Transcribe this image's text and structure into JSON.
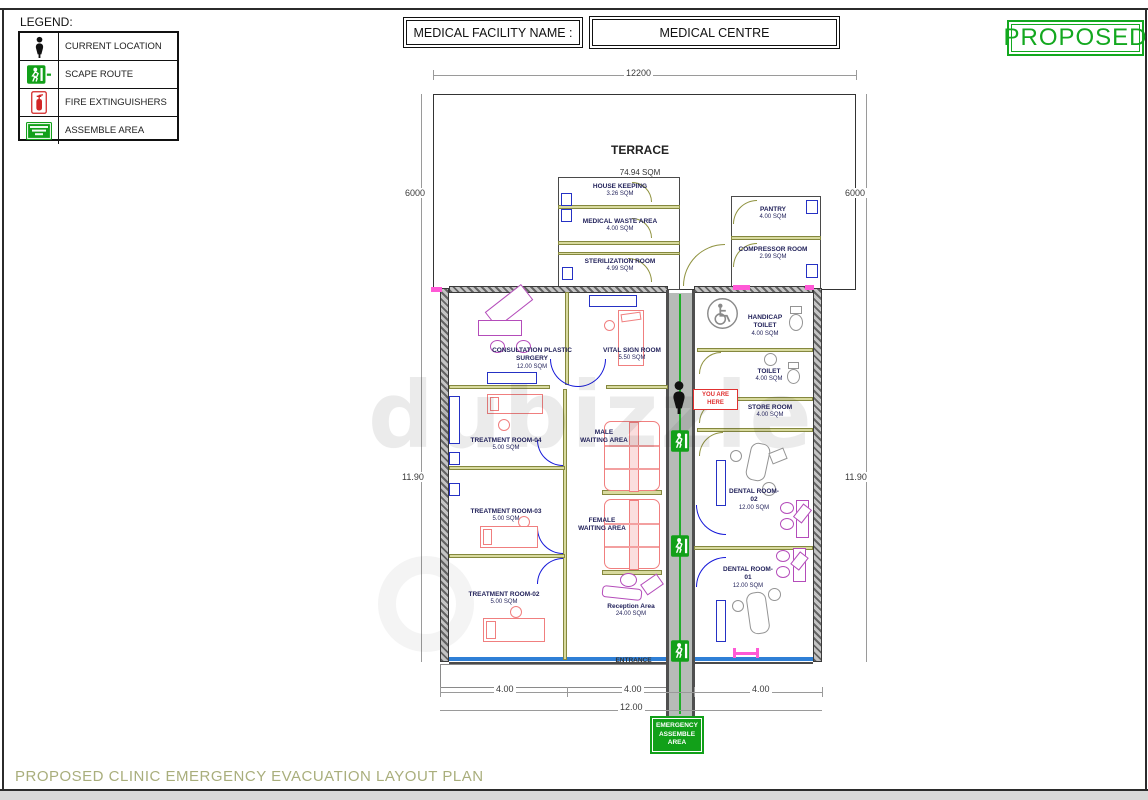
{
  "legend": {
    "title": "LEGEND:",
    "items": [
      {
        "icon": "current-location-icon",
        "label": "CURRENT LOCATION"
      },
      {
        "icon": "escape-route-icon",
        "label": "SCAPE ROUTE"
      },
      {
        "icon": "fire-extinguisher-icon",
        "label": "FIRE EXTINGUISHERS"
      },
      {
        "icon": "assemble-area-icon",
        "label": "ASSEMBLE AREA"
      }
    ]
  },
  "header": {
    "facility_label": "MEDICAL FACILITY NAME :",
    "facility_name": "MEDICAL CENTRE",
    "status": "PROPOSED"
  },
  "plan": {
    "rooms": {
      "terrace": {
        "name": "TERRACE",
        "area": "74.94 SQM"
      },
      "house_keeping": {
        "name": "HOUSE KEEPING",
        "area": "3.26 SQM"
      },
      "medical_waste": {
        "name": "MEDICAL WASTE AREA",
        "area": "4.00 SQM"
      },
      "sterilization": {
        "name": "STERILIZATION ROOM",
        "area": "4.99 SQM"
      },
      "pantry": {
        "name": "PANTRY",
        "area": "4.00 SQM"
      },
      "compressor": {
        "name": "COMPRESSOR ROOM",
        "area": "2.99 SQM"
      },
      "consultation": {
        "line1": "CONSULTATION PLASTIC",
        "line2": "SURGERY",
        "area": "12.00 SQM"
      },
      "vital_sign": {
        "name": "VITAL SIGN ROOM",
        "area": "5.50 SQM"
      },
      "handicap_toilet": {
        "line1": "HANDICAP",
        "line2": "TOILET",
        "area": "4.00 SQM"
      },
      "toilet": {
        "name": "TOILET",
        "area": "4.00 SQM"
      },
      "store": {
        "name": "STORE ROOM",
        "area": "4.00 SQM"
      },
      "treatment4": {
        "name": "TREATMENT ROOM-04",
        "area": "5.00 SQM"
      },
      "treatment3": {
        "name": "TREATMENT ROOM-03",
        "area": "5.00 SQM"
      },
      "treatment2": {
        "name": "TREATMENT ROOM-02",
        "area": "5.00 SQM"
      },
      "male_waiting": {
        "line1": "MALE",
        "line2": "WAITING AREA"
      },
      "female_waiting": {
        "line1": "FEMALE",
        "line2": "WAITING AREA"
      },
      "reception": {
        "name": "Reception Area",
        "area": "24.00 SQM"
      },
      "dental2": {
        "name": "DENTAL ROOM-02",
        "area": "12.00 SQM"
      },
      "dental1": {
        "name": "DENTAL ROOM-01",
        "area": "12.00 SQM"
      },
      "entrance": {
        "name": "ENTRANCE"
      }
    },
    "markers": {
      "you_are_here": "YOU ARE HERE",
      "assemble_sign": "EMERGENCY ASSEMBLE AREA"
    },
    "dimensions": {
      "top_width": "12200",
      "side_upper": "6000",
      "side_lower": "11.90",
      "bottom_left": "4.00",
      "bottom_mid": "4.00",
      "bottom_right": "4.00",
      "bottom_total": "12.00"
    }
  },
  "footer": {
    "title": "PROPOSED CLINIC EMERGENCY EVACUATION LAYOUT PLAN"
  },
  "watermark": "dubizzle",
  "colors": {
    "accent_green": "#13a81f",
    "alert_red": "#e03131",
    "furniture_red": "#f07f7f",
    "furniture_magenta": "#b44cba",
    "wall_olive": "#d8da9e",
    "door_blue": "#1518d8",
    "footer_olive": "#a9ae7c"
  }
}
